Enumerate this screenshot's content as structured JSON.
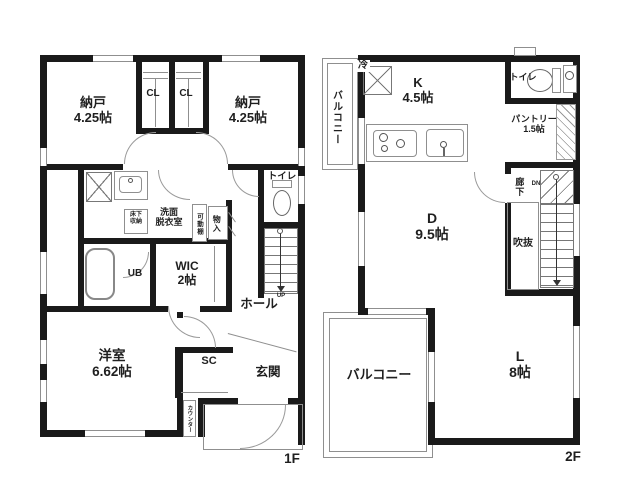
{
  "colors": {
    "wall": "#1a1a1a",
    "thin_line": "#8f8f8f",
    "text": "#1f1f1f",
    "background": "#ffffff"
  },
  "floor1": {
    "floor_label": "1F",
    "labels": {
      "storage_left_name": "納戸",
      "storage_left_size": "4.25帖",
      "closet_left": "CL",
      "closet_right": "CL",
      "storage_right_name": "納戸",
      "storage_right_size": "4.25帖",
      "underfloor_line1": "床下",
      "underfloor_line2": "収納",
      "washroom_line1": "洗面",
      "washroom_line2": "脱衣室",
      "movable_shelf": "可動棚",
      "small_closet": "物入",
      "toilet": "トイレ",
      "bath": "UB",
      "wic_name": "WIC",
      "wic_size": "2帖",
      "hall": "ホール",
      "western_room_name": "洋室",
      "western_room_size": "6.62帖",
      "shoe_closet": "SC",
      "entrance": "玄関",
      "counter": "カウンター",
      "stairs_up": "UP"
    }
  },
  "floor2": {
    "floor_label": "2F",
    "labels": {
      "balcony_upper": "バルコニー",
      "refrigerator": "冷",
      "kitchen_name": "K",
      "kitchen_size": "4.5帖",
      "toilet": "トイレ",
      "pantry_name": "パントリー",
      "pantry_size": "1.5帖",
      "corridor": "廊下",
      "stairs_down": "DN",
      "void": "吹抜",
      "dining_name": "D",
      "dining_size": "9.5帖",
      "balcony_lower": "バルコニー",
      "living_name": "L",
      "living_size": "8帖"
    }
  }
}
